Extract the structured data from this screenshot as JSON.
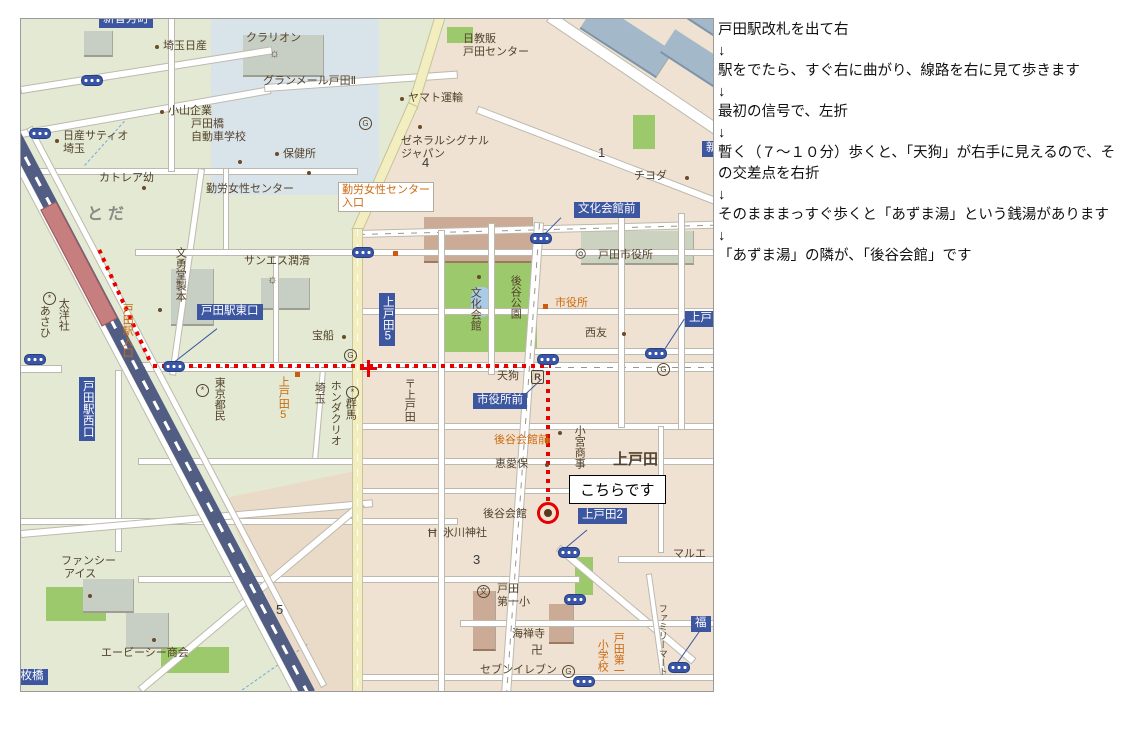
{
  "colors": {
    "bus_label_bg": "#3d56a0",
    "route_red": "#e60000",
    "orange_text": "#cc6a10",
    "brown_text": "#53422c"
  },
  "directions": {
    "arrow": "↓",
    "steps": [
      "戸田駅改札を出て右",
      "駅をでたら、すぐ右に曲がり、線路を右に見て歩きます",
      "最初の信号で、左折",
      "暫く（７～１０分）歩くと、「天狗」が右手に見えるので、その交差点を右折",
      "そのまままっすぐ歩くと「あずま湯」という銭湯があります",
      "「あずま湯」の隣が、「後谷会館」です"
    ]
  },
  "map": {
    "callout": "こちらです",
    "labels": [
      {
        "n": "bus-label-shinzo",
        "t": "新曽芳町",
        "x": 78,
        "y": -7,
        "c": "bl"
      },
      {
        "n": "bus-label-toda-east-exit",
        "t": "戸田駅東口",
        "x": 176,
        "y": 285,
        "c": "bl"
      },
      {
        "n": "bus-label-toda-west-exit",
        "t": "戸田駅西口",
        "x": 58,
        "y": 358,
        "c": "blv"
      },
      {
        "n": "bus-label-kamitoda5",
        "t": "上戸田5",
        "x": 358,
        "y": 274,
        "c": "blv"
      },
      {
        "n": "bus-label-bunkakaikan-mae",
        "t": "文化会館前",
        "x": 553,
        "y": 183,
        "c": "bl"
      },
      {
        "n": "bus-label-shiyakusho-mae",
        "t": "市役所前",
        "x": 452,
        "y": 374,
        "c": "bl"
      },
      {
        "n": "bus-label-kamitoda2",
        "t": "上戸田2",
        "x": 557,
        "y": 489,
        "c": "bl"
      },
      {
        "n": "bus-label-kamitoda",
        "t": "上戸田",
        "x": 664,
        "y": 292,
        "c": "bl"
      },
      {
        "n": "bus-label-maibashi",
        "t": "五枚橋",
        "x": -16,
        "y": 650,
        "c": "bl"
      },
      {
        "n": "bus-label-fuku",
        "t": "福",
        "x": 670,
        "y": 597,
        "c": "bl"
      },
      {
        "n": "bus-label-right-clipped",
        "t": "新",
        "x": 681,
        "y": 122,
        "c": "bl"
      },
      {
        "n": "label-toda-station-entrance",
        "t": "戸田駅入口",
        "x": 99,
        "y": 284,
        "c": "orv"
      },
      {
        "n": "label-kamitoda5-road",
        "t": "上戸田5",
        "x": 255,
        "y": 357,
        "c": "orv"
      },
      {
        "n": "label-kinro-josei-center-iriguchi",
        "t": "勤労女性センター\n入口",
        "x": 317,
        "y": 163,
        "c": "orbox"
      },
      {
        "n": "label-shiyakusho-stop",
        "t": "市役所",
        "x": 534,
        "y": 278,
        "c": "or"
      },
      {
        "n": "label-koyakaikan-mae-stop",
        "t": "後谷会館前",
        "x": 473,
        "y": 415,
        "c": "or"
      },
      {
        "n": "label-toda-daiichi-es-col1",
        "t": "戸田第一",
        "x": 590,
        "y": 613,
        "c": "orv"
      },
      {
        "n": "label-toda-daiichi-es-col2",
        "t": "小学校",
        "x": 574,
        "y": 620,
        "c": "orv"
      },
      {
        "t": "埼玉日産",
        "x": 142,
        "y": 21
      },
      {
        "t": "小山企業",
        "x": 147,
        "y": 86
      },
      {
        "t": "日産サティオ\n埼玉",
        "x": 42,
        "y": 111
      },
      {
        "t": "戸田橋\n自動車学校",
        "x": 170,
        "y": 99
      },
      {
        "t": "カトレア幼",
        "x": 78,
        "y": 153
      },
      {
        "t": "勤労女性センター",
        "x": 185,
        "y": 164
      },
      {
        "t": "クラリオン",
        "x": 225,
        "y": 13
      },
      {
        "t": "グランメール戸田Ⅱ",
        "x": 242,
        "y": 56
      },
      {
        "t": "ヤマト運輸",
        "x": 387,
        "y": 73
      },
      {
        "t": "保健所",
        "x": 262,
        "y": 129
      },
      {
        "t": "ゼネラルシグナル\nジャパン",
        "x": 380,
        "y": 116
      },
      {
        "t": "日教販\n戸田センター",
        "x": 442,
        "y": 14
      },
      {
        "t": "チヨダ",
        "x": 613,
        "y": 151
      },
      {
        "n": "station-name",
        "t": "とだ",
        "x": 66,
        "y": 186,
        "c": "sta"
      },
      {
        "t": "あさひ",
        "x": 16,
        "y": 286,
        "c": "brv"
      },
      {
        "t": "太洋社",
        "x": 35,
        "y": 279,
        "c": "brv"
      },
      {
        "t": "文勇堂製本",
        "x": 152,
        "y": 228,
        "c": "brv"
      },
      {
        "t": "サンエス潤滑",
        "x": 223,
        "y": 236
      },
      {
        "t": "宝船",
        "x": 291,
        "y": 311
      },
      {
        "t": "東京都民",
        "x": 191,
        "y": 358,
        "c": "brv"
      },
      {
        "t": "埼玉",
        "x": 291,
        "y": 363,
        "c": "brv"
      },
      {
        "t": "ホンダクリオ",
        "x": 307,
        "y": 361,
        "c": "brv"
      },
      {
        "t": "群馬",
        "x": 322,
        "y": 379,
        "c": "brv"
      },
      {
        "t": "〒上戸田",
        "x": 381,
        "y": 359,
        "c": "brv"
      },
      {
        "t": "文化会館",
        "x": 447,
        "y": 268,
        "c": "brv"
      },
      {
        "t": "後谷公園",
        "x": 487,
        "y": 256,
        "c": "brv"
      },
      {
        "t": "戸田市役所",
        "x": 577,
        "y": 230
      },
      {
        "t": "西友",
        "x": 564,
        "y": 308
      },
      {
        "n": "label-tengu",
        "t": "天狗",
        "x": 476,
        "y": 351
      },
      {
        "t": "小宮商事",
        "x": 551,
        "y": 406,
        "c": "brv"
      },
      {
        "t": "恵愛保",
        "x": 474,
        "y": 439
      },
      {
        "t": "上戸田",
        "x": 592,
        "y": 432,
        "c": "big"
      },
      {
        "n": "label-koya-kaikan",
        "t": "後谷会館",
        "x": 462,
        "y": 489
      },
      {
        "t": "氷川神社",
        "x": 422,
        "y": 508
      },
      {
        "t": "戸田\n第一小",
        "x": 476,
        "y": 564
      },
      {
        "t": "海禅寺",
        "x": 491,
        "y": 609
      },
      {
        "t": "セブンイレブン",
        "x": 459,
        "y": 645
      },
      {
        "t": "マルエ",
        "x": 652,
        "y": 529
      },
      {
        "t": "ファミリーマート",
        "x": 636,
        "y": 585,
        "c": "brv",
        "fs": 9
      },
      {
        "t": "エービーシー商会",
        "x": 80,
        "y": 628
      },
      {
        "t": "ファンシー\n アイス",
        "x": 40,
        "y": 536
      },
      {
        "n": "road-number",
        "t": "4",
        "x": 401,
        "y": 136,
        "c": "num"
      },
      {
        "n": "road-number",
        "t": "1",
        "x": 577,
        "y": 126,
        "c": "num"
      },
      {
        "n": "road-number",
        "t": "3",
        "x": 452,
        "y": 533,
        "c": "num"
      },
      {
        "n": "road-number",
        "t": "5",
        "x": 255,
        "y": 583,
        "c": "num"
      }
    ],
    "icons": [
      {
        "k": "signal",
        "n": "traffic-signal-icon",
        "x": 60,
        "y": 56
      },
      {
        "k": "signal",
        "n": "traffic-signal-icon",
        "x": 8,
        "y": 109
      },
      {
        "k": "signal",
        "n": "traffic-signal-icon",
        "x": 331,
        "y": 228
      },
      {
        "k": "signal",
        "n": "traffic-signal-icon",
        "x": 509,
        "y": 214
      },
      {
        "k": "signal",
        "n": "traffic-signal-icon",
        "x": 516,
        "y": 335
      },
      {
        "k": "signal",
        "n": "traffic-signal-icon",
        "x": 624,
        "y": 329
      },
      {
        "k": "signal",
        "n": "traffic-signal-icon",
        "x": 142,
        "y": 342
      },
      {
        "k": "signal",
        "n": "traffic-signal-icon",
        "x": 3,
        "y": 335
      },
      {
        "k": "signal",
        "n": "traffic-signal-icon",
        "x": 537,
        "y": 528
      },
      {
        "k": "signal",
        "n": "traffic-signal-icon",
        "x": 543,
        "y": 575
      },
      {
        "k": "signal",
        "n": "traffic-signal-icon",
        "x": 552,
        "y": 657
      },
      {
        "k": "signal",
        "n": "traffic-signal-icon",
        "x": 647,
        "y": 643
      },
      {
        "k": "dot",
        "n": "poi-dot-icon",
        "x": 134,
        "y": 26
      },
      {
        "k": "dot",
        "n": "poi-dot-icon",
        "x": 139,
        "y": 91
      },
      {
        "k": "dot",
        "n": "poi-dot-icon",
        "x": 34,
        "y": 120
      },
      {
        "k": "dot",
        "n": "poi-dot-icon",
        "x": 121,
        "y": 167
      },
      {
        "k": "dot",
        "n": "poi-dot-icon",
        "x": 217,
        "y": 141
      },
      {
        "k": "dot",
        "n": "poi-dot-icon",
        "x": 379,
        "y": 78
      },
      {
        "k": "dot",
        "n": "poi-dot-icon",
        "x": 254,
        "y": 133
      },
      {
        "k": "dot",
        "n": "poi-dot-icon",
        "x": 286,
        "y": 152
      },
      {
        "k": "dot",
        "n": "poi-dot-icon",
        "x": 397,
        "y": 106
      },
      {
        "k": "dot",
        "n": "poi-dot-icon",
        "x": 321,
        "y": 316
      },
      {
        "k": "dot",
        "n": "poi-dot-icon",
        "x": 137,
        "y": 289
      },
      {
        "k": "dot",
        "n": "poi-dot-icon",
        "x": 456,
        "y": 256
      },
      {
        "k": "dot",
        "n": "poi-dot-icon",
        "x": 601,
        "y": 313
      },
      {
        "k": "dot",
        "n": "poi-dot-icon",
        "x": 664,
        "y": 157
      },
      {
        "k": "dot",
        "n": "poi-dot-icon",
        "x": 524,
        "y": 444
      },
      {
        "k": "dot",
        "n": "poi-dot-icon",
        "x": 67,
        "y": 575
      },
      {
        "k": "dot",
        "n": "poi-dot-icon",
        "x": 131,
        "y": 619
      },
      {
        "k": "dot",
        "n": "poi-dot-icon",
        "x": 537,
        "y": 412
      },
      {
        "k": "diamond",
        "n": "bus-stop-marker-icon",
        "x": 522,
        "y": 285
      },
      {
        "k": "diamond",
        "n": "bus-stop-marker-icon",
        "x": 274,
        "y": 353
      },
      {
        "k": "diamond",
        "n": "bus-stop-marker-icon",
        "x": 524,
        "y": 419
      },
      {
        "k": "diamond",
        "n": "bus-stop-marker-icon",
        "x": 372,
        "y": 232
      },
      {
        "k": "sun",
        "n": "sun-symbol-icon",
        "g": "☼",
        "x": 248,
        "y": 28
      },
      {
        "k": "sun",
        "n": "sun-symbol-icon",
        "g": "☼",
        "x": 246,
        "y": 254
      },
      {
        "k": "cmark",
        "n": "company-mark-icon",
        "g": "*",
        "x": 175,
        "y": 365
      },
      {
        "k": "cmark",
        "n": "company-mark-icon",
        "g": "*",
        "x": 325,
        "y": 367
      },
      {
        "k": "cmark",
        "n": "company-mark-icon",
        "g": "*",
        "x": 22,
        "y": 273
      },
      {
        "k": "cityhall",
        "n": "city-hall-icon",
        "g": "◎",
        "x": 554,
        "y": 227
      },
      {
        "k": "school",
        "n": "school-icon",
        "g": "文",
        "x": 456,
        "y": 566
      },
      {
        "k": "gas",
        "n": "landmark-g-icon",
        "g": "G",
        "x": 323,
        "y": 330
      },
      {
        "k": "gas",
        "n": "landmark-g-icon",
        "g": "G",
        "x": 636,
        "y": 344
      },
      {
        "k": "gas",
        "n": "landmark-g-icon",
        "g": "G",
        "x": 541,
        "y": 646
      },
      {
        "k": "gas",
        "n": "landmark-g-icon",
        "g": "G",
        "x": 338,
        "y": 98
      },
      {
        "k": "rest",
        "n": "restaurant-icon",
        "g": "R",
        "x": 510,
        "y": 351
      },
      {
        "k": "shrine",
        "n": "shrine-torii-icon",
        "g": "Ħ",
        "x": 407,
        "y": 508
      },
      {
        "k": "temple",
        "n": "temple-manji-icon",
        "g": "卍",
        "x": 510,
        "y": 625
      }
    ]
  }
}
